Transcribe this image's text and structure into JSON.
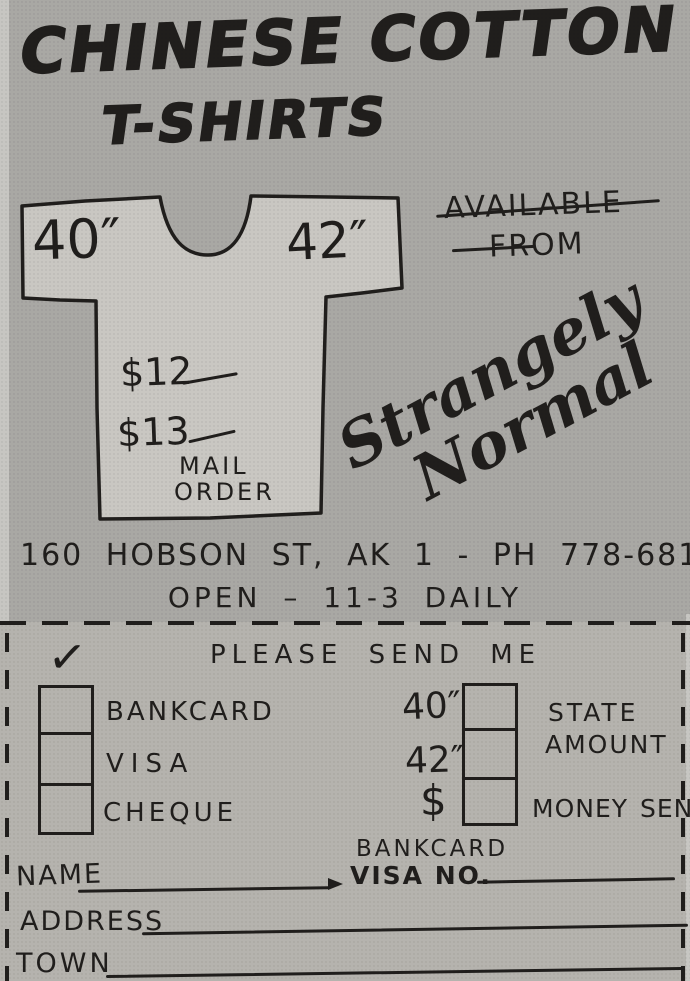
{
  "colors": {
    "paper_top": "#a9a8a4",
    "paper_bottom": "#b5b3ae",
    "shirt_fill": "#c9c7c2",
    "ink": "#201e1c",
    "edge_light": "#c7c6c2"
  },
  "ad": {
    "title_line1": "CHINESE COTTON",
    "title_line2": "T-SHIRTS",
    "shirt": {
      "size_left": "40″",
      "size_right": "42″",
      "price_line1": "$12",
      "price_line2": "$13",
      "note_line1": "MAIL",
      "note_line2": "ORDER"
    },
    "availability": {
      "line1": "AVAILABLE",
      "line2": "FROM",
      "brand_line1": "Strangely",
      "brand_line2": "Normal"
    },
    "address": "160 HOBSON ST, AK 1 - PH 778-681",
    "hours": "OPEN – 11-3 DAILY"
  },
  "form": {
    "checkmark": "✓",
    "heading": "PLEASE SEND ME",
    "payment_options": [
      "BANKCARD",
      "VISA",
      "CHEQUE"
    ],
    "size_options": [
      "40″",
      "42″",
      "$"
    ],
    "amount_hint_line1": "STATE",
    "amount_hint_line2": "AMOUNT",
    "money_sent_label": "MONEY SENT",
    "card_label_line1": "BANKCARD",
    "card_label_line2": "VISA NO.",
    "name_label": "NAME",
    "address_label": "ADDRESS",
    "town_label": "TOWN"
  }
}
